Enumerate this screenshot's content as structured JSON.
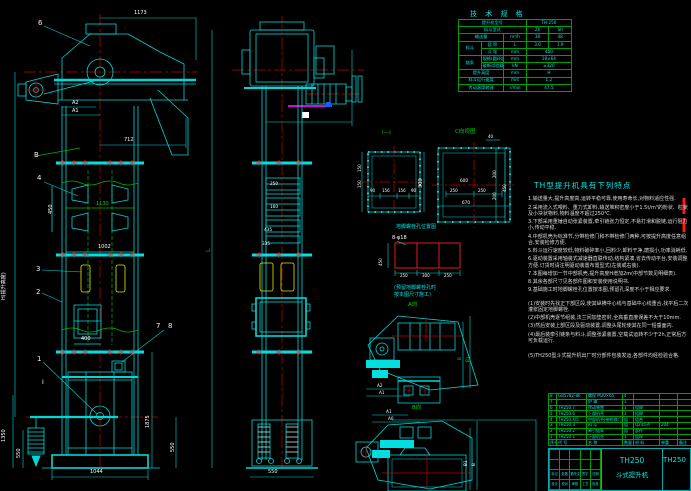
{
  "spec": {
    "title": "技 术 规 格",
    "model_label": "提升机型号",
    "model": "TH 250",
    "type_label": "料斗型式",
    "type1": "Zh",
    "type2": "Sh",
    "cap_label": "输送量",
    "cap_unit": "m³/h",
    "cap1": "30",
    "cap2": "48",
    "bucket_group": "料斗",
    "vol_label": "容 积",
    "vol_unit": "L",
    "vol1": "3.0",
    "vol2": "1.9",
    "pitch_label": "斗 距",
    "pitch_unit": "mm",
    "pitch": "450",
    "chain_group": "链条",
    "chain_label": "规格(圆环链)",
    "chain_unit": "mm",
    "chain": "18×64",
    "break_label": "破断试验载荷",
    "break_unit": "kN",
    "break_val": "≥320",
    "height_label": "提升高度",
    "height_unit": "mm",
    "height_val": "H",
    "speed_label": "料斗运行速度",
    "speed_unit": "m/s",
    "speed": "1.2",
    "rpm_label": "传动滚筒转速",
    "rpm_unit": "r/min",
    "rpm": "47.5"
  },
  "features": {
    "title": "TH型提升机具有下列特点",
    "lines": [
      "1.输送量大,提升高度高,运转平稳可靠,使用寿命长,对物料适应性强.",
      "2.采用流入式喂料、重力式卸料,输送堆积密度小于1.5t/m³的粉状、粒状及小块状物料,物料温度不超过250℃.",
      "3.下部采用重锤自动张紧装置,牵引链张力恒定,不易打滑和脱链,运行阻力小,传动平稳.",
      "4.中部机壳为标准节,分带检修门和不带检修门两种,可按提升高度任意组合,安装检修方便.",
      "5.料斗运行速度较低,物料破碎率小,回料少,卸料干净,磨损小,功率消耗低.",
      "6.驱动装置采用轴装式减速器直联传动,结构紧凑,省去传动平台,安装调整方便.订货时请注明驱动装置布置型式(左装或右装).",
      "7.本图每增加一节中部机壳,提升高度H增加2m(中部节数见明细表).",
      "8.其余各部尺寸见各部件图和安装使用说明书.",
      "9.基础施工时地脚螺栓孔位置按本图,预留孔深度不小于相应要求."
    ],
    "notes": [
      "(1)安装时先找正下部区段,使其纵横中心线与基础中心线重合,找平后二次灌浆固定地脚螺栓.",
      "(2)中部机壳逐节组装,法兰间加垫密封,全高垂直度误差不大于10mm.",
      "(3)然后安装上部区段及驱动装置,调整头尾轮使其在同一铅垂面内.",
      "(4)最后装牵引链条与料斗,调整张紧装置,空载试运转不少于2h,正常后方可负载运行."
    ],
    "final": "(5)TH250型斗式提升机出厂时分部件包装发运,各部件均经检验合格."
  },
  "bom": {
    "header": [
      "序号",
      "代  号",
      "名  称",
      "数量",
      "材  料",
      "单重",
      "备注"
    ],
    "rows": [
      [
        "8",
        "GB5782-86",
        "螺栓 M20×65",
        "4",
        "",
        "",
        ""
      ],
      [
        "7",
        "",
        "护  罩",
        "1",
        "",
        "",
        ""
      ],
      [
        "6",
        "TH250.7",
        "传动装置",
        "1",
        "组焊",
        "",
        ""
      ],
      [
        "5",
        "TH250.6",
        "上部机壳",
        "1",
        "组焊",
        "",
        ""
      ],
      [
        "4",
        "TH250.4/5",
        "中部机壳(带检修门)",
        "组",
        "组合",
        "",
        ""
      ],
      [
        "3",
        "TH250.3",
        "料  斗",
        "组",
        "Q235-A",
        "204",
        ""
      ],
      [
        "2",
        "TH250.2",
        "牵引链条",
        "组",
        "部件",
        "",
        ""
      ],
      [
        "1",
        "TH250.1",
        "下部机壳",
        "1",
        "组焊",
        "",
        ""
      ]
    ]
  },
  "titleblock": {
    "model": "TH250",
    "product": "斗式提升机",
    "drawing_no": "TH250",
    "rev_labels": [
      "标记",
      "处数",
      "更改文件号",
      "签字",
      "日期"
    ],
    "sign_labels": [
      "设计",
      "校对",
      "审核",
      "工艺",
      "批准"
    ]
  },
  "dims": {
    "d1173": "1173",
    "a2": "A2",
    "a1": "A1",
    "d712": "712",
    "d450": "450",
    "d1130": "1130",
    "d1002": "1002",
    "d400": "400",
    "d1044": "1044",
    "d1350": "1350",
    "d550l": "550",
    "d1875": "1875",
    "d550r": "550",
    "L": "L",
    "h_note": "H(提升高度)",
    "m250": "250",
    "m160": "160",
    "m435": "435",
    "m335": "335",
    "m550": "550",
    "c6": "6",
    "c4": "4",
    "c3": "3",
    "c2": "2",
    "c1": "1",
    "c7": "7",
    "c8": "8",
    "cB": "B",
    "mark_i": "I"
  },
  "sec_i": {
    "label": "I—I",
    "r300": "300",
    "l150a": "150",
    "l150b": "150",
    "b": [
      "90",
      "156",
      "156",
      "90"
    ]
  },
  "sec_c": {
    "label": "C向视图",
    "t40": "40",
    "i600": "600",
    "b250a": "250",
    "b250b": "250",
    "b670": "670",
    "r200a": "200",
    "r200b": "200",
    "r450": "450"
  },
  "anchor": {
    "caption": "地脚螺栓孔位置图",
    "bolt": "8-φ18",
    "v450": "450",
    "b": [
      "250",
      "300",
      "250"
    ],
    "note1": "(预留地脚螺栓孔时",
    "note2": "按本图尺寸施工)",
    "view_a": "A向",
    "view_b": "B向"
  },
  "detail_a": {
    "a2": "A2",
    "a1": "A1",
    "b": "B",
    "b1": "B1"
  },
  "detail_b": {
    "a1": "A1",
    "a0": "A0",
    "b": "B",
    "b1": "B1"
  }
}
